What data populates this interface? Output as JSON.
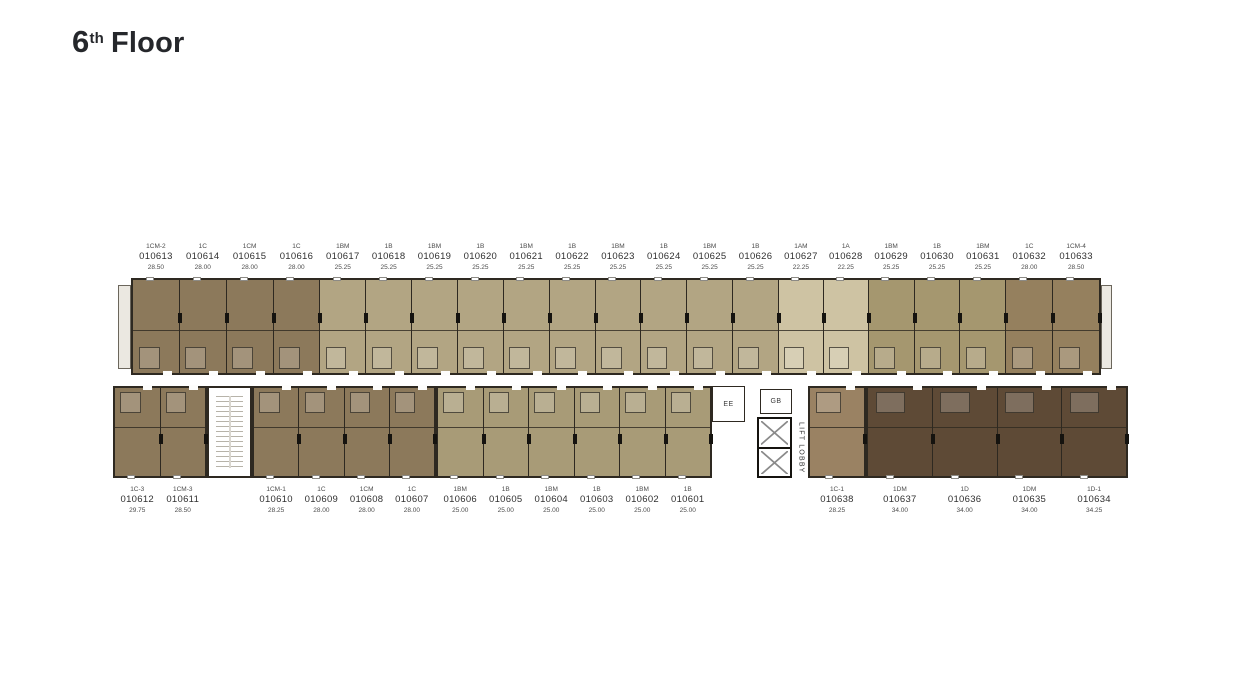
{
  "title": {
    "number": "6",
    "ordinal": "th",
    "word": "Floor"
  },
  "colors": {
    "brown": "#8C795B",
    "khaki": "#B2A583",
    "cream": "#CEC3A3",
    "khaki2": "#A5976F",
    "brown2": "#95805E",
    "olive": "#A89B77",
    "taupe": "#9A8263",
    "dark": "#5E4A36",
    "wall": "#2E2921"
  },
  "core": {
    "ee": "EE",
    "gb": "GB",
    "lift_lobby": "LIFT LOBBY"
  },
  "units": {
    "top": [
      {
        "type": "1CM-2",
        "no": "010613",
        "area": "28.50",
        "color": "brown",
        "w": 47
      },
      {
        "type": "1C",
        "no": "010614",
        "area": "28.00",
        "color": "brown",
        "w": 47
      },
      {
        "type": "1CM",
        "no": "010615",
        "area": "28.00",
        "color": "brown",
        "w": 47
      },
      {
        "type": "1C",
        "no": "010616",
        "area": "28.00",
        "color": "brown",
        "w": 47
      },
      {
        "type": "1BM",
        "no": "010617",
        "area": "25.25",
        "color": "khaki",
        "w": 46
      },
      {
        "type": "1B",
        "no": "010618",
        "area": "25.25",
        "color": "khaki",
        "w": 46
      },
      {
        "type": "1BM",
        "no": "010619",
        "area": "25.25",
        "color": "khaki",
        "w": 46
      },
      {
        "type": "1B",
        "no": "010620",
        "area": "25.25",
        "color": "khaki",
        "w": 46
      },
      {
        "type": "1BM",
        "no": "010621",
        "area": "25.25",
        "color": "khaki",
        "w": 46
      },
      {
        "type": "1B",
        "no": "010622",
        "area": "25.25",
        "color": "khaki",
        "w": 46
      },
      {
        "type": "1BM",
        "no": "010623",
        "area": "25.25",
        "color": "khaki",
        "w": 46
      },
      {
        "type": "1B",
        "no": "010624",
        "area": "25.25",
        "color": "khaki",
        "w": 46
      },
      {
        "type": "1BM",
        "no": "010625",
        "area": "25.25",
        "color": "khaki",
        "w": 46
      },
      {
        "type": "1B",
        "no": "010626",
        "area": "25.25",
        "color": "khaki",
        "w": 46
      },
      {
        "type": "1AM",
        "no": "010627",
        "area": "22.25",
        "color": "cream",
        "w": 45
      },
      {
        "type": "1A",
        "no": "010628",
        "area": "22.25",
        "color": "cream",
        "w": 45
      },
      {
        "type": "1BM",
        "no": "010629",
        "area": "25.25",
        "color": "khaki2",
        "w": 46
      },
      {
        "type": "1B",
        "no": "010630",
        "area": "25.25",
        "color": "khaki2",
        "w": 46
      },
      {
        "type": "1BM",
        "no": "010631",
        "area": "25.25",
        "color": "khaki2",
        "w": 46
      },
      {
        "type": "1C",
        "no": "010632",
        "area": "28.00",
        "color": "brown2",
        "w": 47
      },
      {
        "type": "1CM-4",
        "no": "010633",
        "area": "28.50",
        "color": "brown2",
        "w": 47
      }
    ],
    "bottom_left": [
      {
        "type": "1C-3",
        "no": "010612",
        "area": "29.75",
        "color": "brown",
        "w": 47
      },
      {
        "type": "1CM-3",
        "no": "010611",
        "area": "28.50",
        "color": "brown",
        "w": 47
      }
    ],
    "bottom_mid_west": [
      {
        "type": "1CM-1",
        "no": "010610",
        "area": "28.25",
        "color": "brown",
        "w": 46
      },
      {
        "type": "1C",
        "no": "010609",
        "area": "28.00",
        "color": "brown",
        "w": 46
      },
      {
        "type": "1CM",
        "no": "010608",
        "area": "28.00",
        "color": "brown",
        "w": 46
      },
      {
        "type": "1C",
        "no": "010607",
        "area": "28.00",
        "color": "brown",
        "w": 46
      }
    ],
    "bottom_mid_east": [
      {
        "type": "1BM",
        "no": "010606",
        "area": "25.00",
        "color": "olive",
        "w": 46
      },
      {
        "type": "1B",
        "no": "010605",
        "area": "25.00",
        "color": "olive",
        "w": 46
      },
      {
        "type": "1BM",
        "no": "010604",
        "area": "25.00",
        "color": "olive",
        "w": 46
      },
      {
        "type": "1B",
        "no": "010603",
        "area": "25.00",
        "color": "olive",
        "w": 46
      },
      {
        "type": "1BM",
        "no": "010602",
        "area": "25.00",
        "color": "olive",
        "w": 46
      },
      {
        "type": "1B",
        "no": "010601",
        "area": "25.00",
        "color": "olive",
        "w": 46
      }
    ],
    "bottom_core_east": [
      {
        "type": "1C-1",
        "no": "010638",
        "area": "28.25",
        "color": "taupe",
        "w": 58
      }
    ],
    "bottom_right": [
      {
        "type": "1DM",
        "no": "010637",
        "area": "34.00",
        "color": "dark",
        "w": 65
      },
      {
        "type": "1D",
        "no": "010636",
        "area": "34.00",
        "color": "dark",
        "w": 65
      },
      {
        "type": "1DM",
        "no": "010635",
        "area": "34.00",
        "color": "dark",
        "w": 65
      },
      {
        "type": "1D-1",
        "no": "010634",
        "area": "34.25",
        "color": "dark",
        "w": 65
      }
    ]
  }
}
